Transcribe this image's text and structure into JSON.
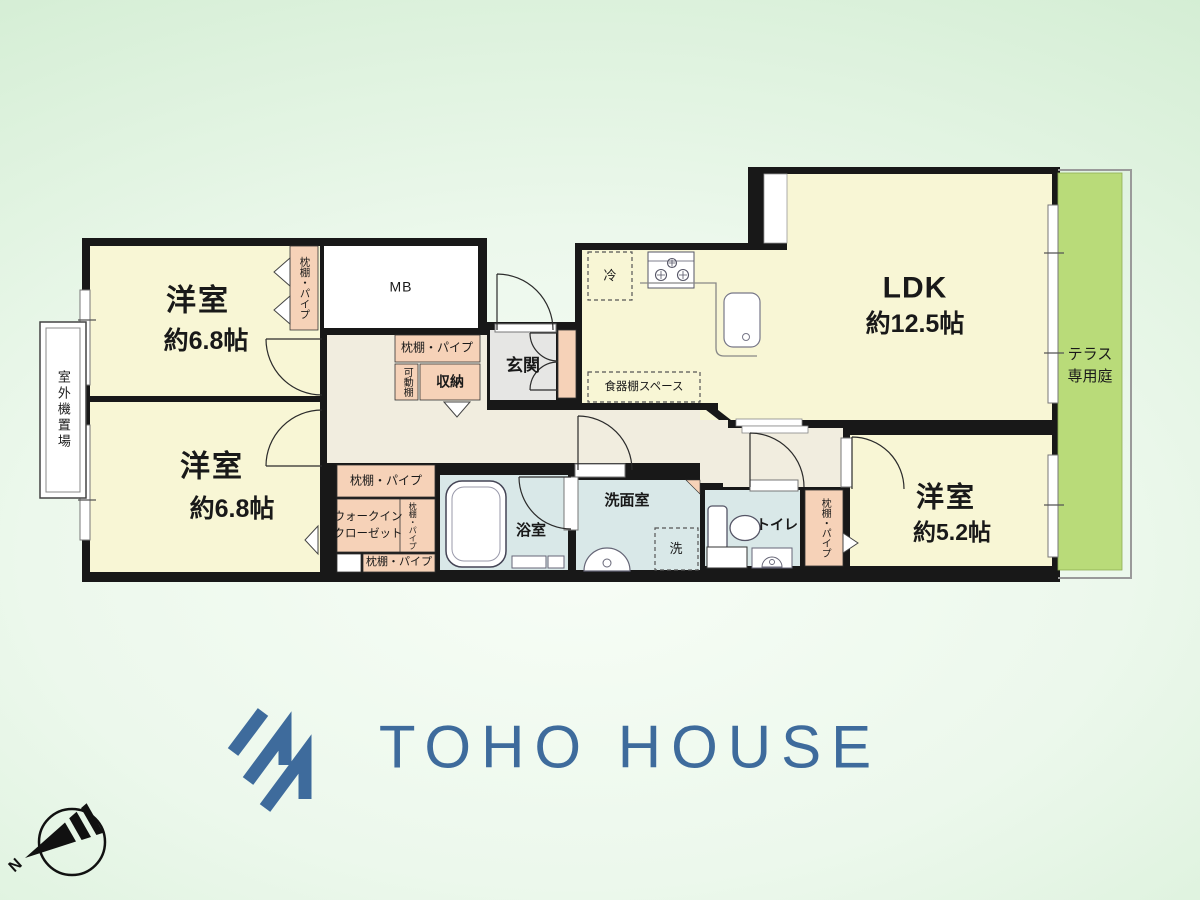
{
  "branding": {
    "logo_text": "TOHO HOUSE"
  },
  "compass": {
    "north_label": "N"
  },
  "rooms": {
    "bedroom_a": {
      "name": "洋室",
      "size": "約6.8帖"
    },
    "bedroom_b": {
      "name": "洋室",
      "size": "約6.8帖"
    },
    "bedroom_c": {
      "name": "洋室",
      "size": "約5.2帖"
    },
    "ldk": {
      "name": "LDK",
      "size": "約12.5帖"
    },
    "terrace": {
      "line1": "テラス",
      "line2": "専用庭"
    },
    "entrance": {
      "label": "玄関"
    },
    "bathroom": {
      "label": "浴室"
    },
    "washroom": {
      "label": "洗面室"
    },
    "toilet": {
      "label": "トイレ"
    }
  },
  "features": {
    "outdoor_unit": "室外機置場",
    "meter_box": "MB",
    "shelf_pipe": "枕棚・パイプ",
    "movable_shelf": "可動棚",
    "storage": "収納",
    "refrigerator": "冷",
    "dish_shelf_space": "食器棚スペース",
    "walk_in_closet_line1": "ウォークイン",
    "walk_in_closet_line2": "クローゼット",
    "washer": "洗"
  },
  "colors": {
    "logo_blue": "#3e6b9c",
    "room_yellow": "#f8f6d5",
    "closet_pink": "#f6d2b8",
    "wet_area_blue": "#d9e8e8",
    "terrace_green": "#b9db79"
  }
}
